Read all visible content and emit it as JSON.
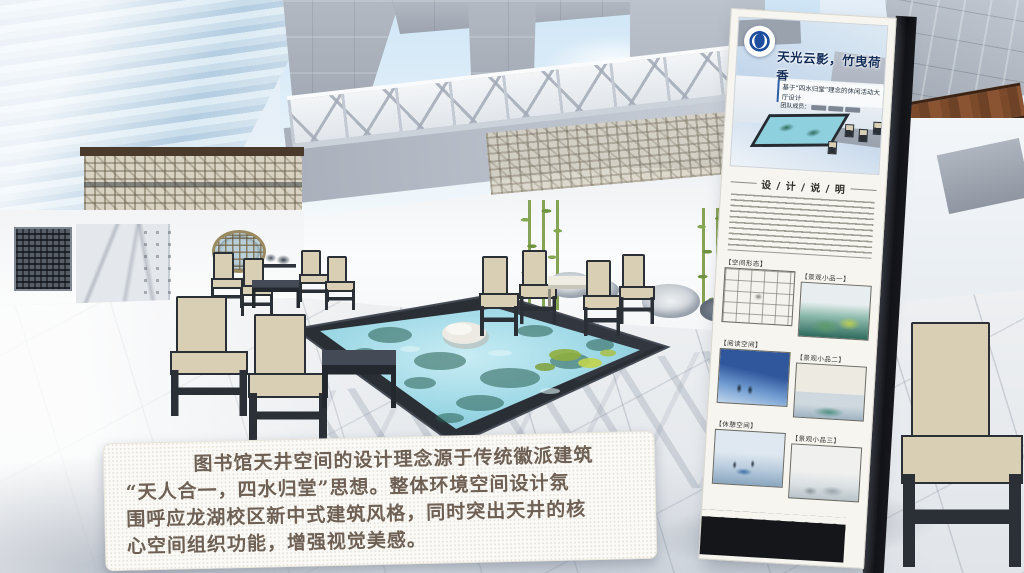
{
  "caption": {
    "lines": [
      "图书馆天井空间的设计理念源于传统徽派建筑",
      "“天人合一，四水归堂”思想。整体环境空间设计氛",
      "围呼应龙湖校区新中式建筑风格，同时突出天井的核",
      "心空间组织功能，增强视觉美感。"
    ],
    "text_color": "#6e6054"
  },
  "signboard": {
    "title": "天光云影，竹曳荷香",
    "subtitle": "基于“四水归堂”理念的休闲活动大厅设计",
    "team_prefix": "团队成员：",
    "section_header": "设 / 计 / 说 / 明",
    "gallery": [
      {
        "label": "【空间形态】"
      },
      {
        "label": "【景观小品一】"
      },
      {
        "label": "【阅读空间】"
      },
      {
        "label": "【景观小品二】"
      },
      {
        "label": "【休憩空间】"
      },
      {
        "label": "【景观小品三】"
      }
    ],
    "logo_color": "#1d4e9e"
  },
  "colors": {
    "pool_water": "#9fd9e6",
    "pool_border": "#2a2e35",
    "chair_cushion": "#d8cfb4",
    "chair_frame": "#2b2f36",
    "concrete": "#a4abb6",
    "accent_blue": "#1d4e9e",
    "caption_background": "#fbfaf6"
  }
}
